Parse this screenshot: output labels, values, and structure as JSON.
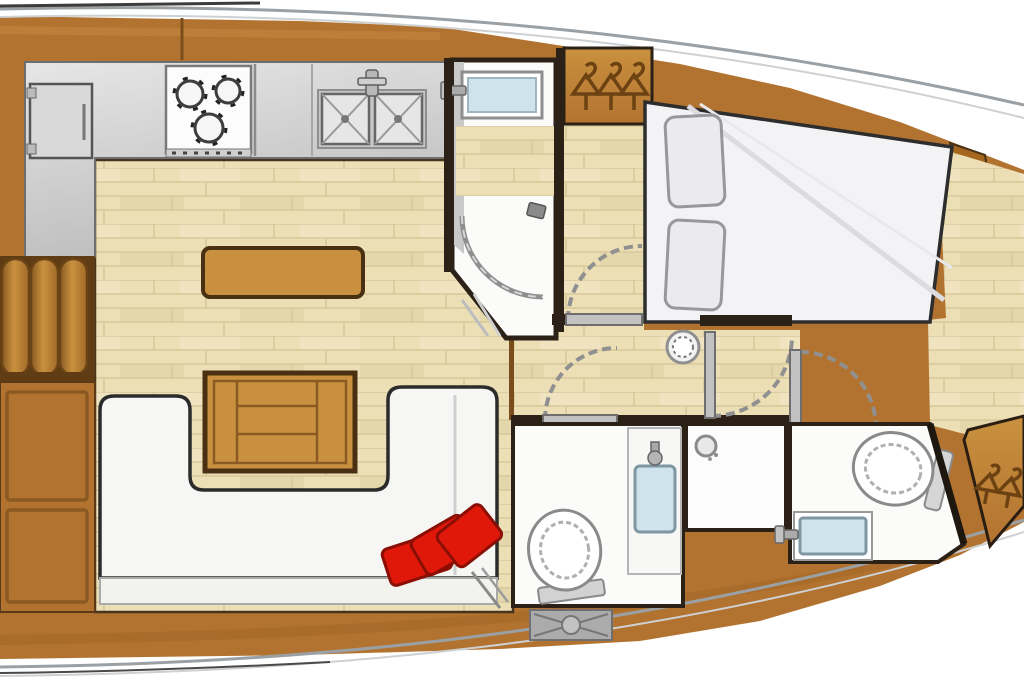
{
  "meta": {
    "title": "Sailboat Interior Floor Plan",
    "type": "yacht accommodation plan, top-down view",
    "orientation": "bow to the right, widest beam at the left edge"
  },
  "colors": {
    "hull_white": "#ffffff",
    "hull_line": "#9aa0a4",
    "hull_line_light": "#cdd1d3",
    "hull_line_dark": "#3c3c3c",
    "wood": "#b37330",
    "wood_light": "#c9913f",
    "wood_dark": "#7a4d1d",
    "wood_edge": "#4a3113",
    "floor": "#ecdfb6",
    "floor_line": "#d8c99c",
    "wall": "#2b2117",
    "counter": "#bdbdbd",
    "counter_light": "#e6e6e6",
    "surface_white": "#fbfbfa",
    "water": "#cfe3ec",
    "water_edge": "#7d97a3",
    "fixture_gray": "#8a8a8a",
    "door_leaf": "#c2c2c2",
    "door_arc": "#909090",
    "red": "#e0180a",
    "red_dark": "#8a0e04"
  },
  "rooms": {
    "galley": {
      "name": "Galley",
      "fixtures": [
        "L-shaped counter",
        "refrigerator",
        "3-burner gimbaled stove",
        "double sink",
        "faucet"
      ]
    },
    "salon": {
      "name": "Salon",
      "fixtures": [
        "U-shaped sofa",
        "folding salon table",
        "sideboard table",
        "red cushions x3",
        "storage cabinet",
        "curved companion steps"
      ]
    },
    "forward_head": {
      "name": "Head with shower (midship)",
      "fixtures": [
        "washbasin",
        "curved shower door",
        "door handle"
      ]
    },
    "hanging_locker_mid": {
      "name": "Hanging locker",
      "fixtures": [
        "clothes hangers x3"
      ]
    },
    "owners_cabin": {
      "name": "Bow cabin",
      "fixtures": [
        "island double bed",
        "pillows x2",
        "hull shelf trim"
      ]
    },
    "corridor": {
      "name": "Passageway",
      "fixtures": [
        "mast post",
        "cabin doors x4"
      ]
    },
    "second_head": {
      "name": "En-suite head",
      "fixtures": [
        "toilet",
        "vanity washbasin",
        "shower stall",
        "deck access plate"
      ]
    },
    "third_head": {
      "name": "Bow head",
      "fixtures": [
        "toilet",
        "washbasin"
      ]
    },
    "hanging_locker_bow": {
      "name": "Hanging locker (bow)",
      "fixtures": [
        "clothes hangers x2"
      ]
    }
  },
  "counts": {
    "stove_burners": 3,
    "galley_sink_basins": 2,
    "toilets": 2,
    "washbasins": 3,
    "showers": 2,
    "doors": 4,
    "red_cushions": 3,
    "bed_pillows": 2,
    "hanging_lockers": 2
  }
}
